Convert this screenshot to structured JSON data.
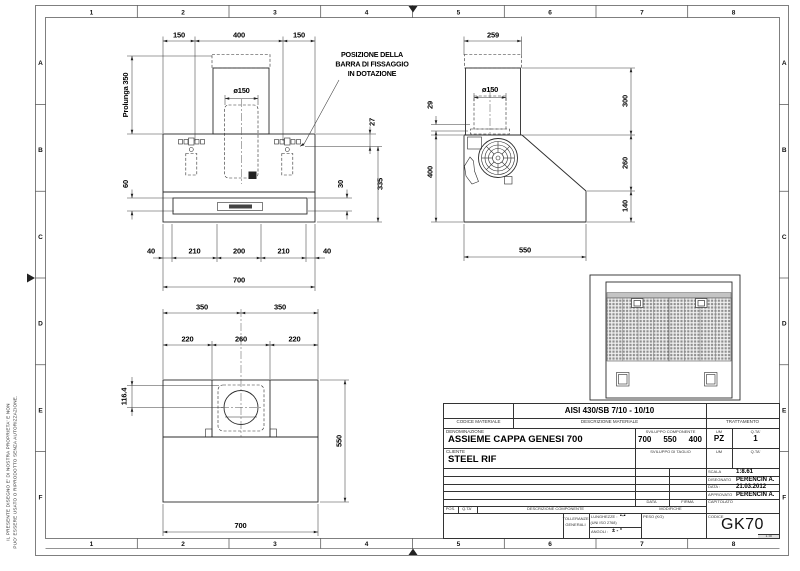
{
  "sheet": {
    "cols": [
      "1",
      "2",
      "3",
      "4",
      "5",
      "6",
      "7",
      "8"
    ],
    "rows": [
      "A",
      "B",
      "C",
      "D",
      "E",
      "F"
    ],
    "disclaimer_line1": "IL PRESENTE DISEGNO E' DI NOSTRA PROPRIETA' E NON",
    "disclaimer_line2": "PUO' ESSERE USATO O RIPRODOTTO SENZA AUTORIZZAZIONE."
  },
  "note": {
    "line1": "POSIZIONE DELLA",
    "line2": "BARRA DI FISSAGGIO",
    "line3": "IN DOTAZIONE"
  },
  "front": {
    "top_left": "150",
    "top_mid": "400",
    "top_right": "150",
    "prolunga": "Prolunga 350",
    "duct": "ø150",
    "right_27": "27",
    "right_335": "335",
    "mid_30": "30",
    "left_60": "60",
    "bot_40l": "40",
    "bot_210l": "210",
    "bot_200": "200",
    "bot_210r": "210",
    "bot_40r": "40",
    "bot_700": "700"
  },
  "side": {
    "top_259": "259",
    "duct": "ø150",
    "left_29": "29",
    "left_400": "400",
    "right_300": "300",
    "right_260": "260",
    "right_140": "140",
    "bot_550": "550"
  },
  "plan": {
    "top_350l": "350",
    "top_350r": "350",
    "mid_220l": "220",
    "mid_260": "260",
    "mid_220r": "220",
    "left_1164": "116.4",
    "right_550": "550",
    "bot_700": "700"
  },
  "titleblock": {
    "material": "AISI 430/SB 7/10 - 10/10",
    "lbl_codice_materiale": "CODICE MATERIALE",
    "lbl_descrizione_materiale": "DESCRIZIONE MATERIALE",
    "lbl_trattamento": "TRATTAMENTO",
    "lbl_denominazione": "DENOMINAZIONE",
    "denominazione": "ASSIEME CAPPA GENESI 700",
    "lbl_sviluppo_componente": "SVILUPPO COMPONENTE",
    "sviluppo_1": "700",
    "sviluppo_2": "550",
    "sviluppo_3": "400",
    "lbl_um": "UM",
    "um": "PZ",
    "lbl_qta": "Q.TA'",
    "qta": "1",
    "lbl_cliente": "CLIENTE",
    "cliente": "STEEL RIF",
    "lbl_sviluppo_taglio": "SVILUPPO DI TAGLIO",
    "lbl_um2": "UM",
    "lbl_qta2": "Q.TA'",
    "lbl_scala": "SCALA",
    "scala": "1:8.61",
    "lbl_disegnato": "DISEGNATO",
    "disegnato": "PERENCIN A.",
    "lbl_data": "DATA :",
    "data": "21.03.2012",
    "lbl_approvato": "APPROVATO",
    "approvato": "PERENCIN A.",
    "lbl_capitolato": "CAPITOLATO",
    "lbl_data_col": "DATA",
    "lbl_firma": "FIRMA",
    "lbl_pos": "POS.",
    "lbl_qta3": "Q.TA'",
    "lbl_descrizione_componente": "DESCRIZIONE COMPONENTE",
    "lbl_modifiche": "MODIFICHE",
    "lbl_tolleranze_1": "TOLLERANZE",
    "lbl_tolleranze_2": "GENERALI",
    "lbl_lunghezze": "LUNGHEZZE :",
    "lunghezze_val": "▪-▪",
    "lbl_uni": "(UNI ISO 2768)",
    "lbl_angoli": "ANGOLI :",
    "angoli_val": "± - °",
    "lbl_peso": "PESO (KG)",
    "lbl_codice": "CODICE",
    "codice": "GK70",
    "sheet_no": "1 di"
  }
}
